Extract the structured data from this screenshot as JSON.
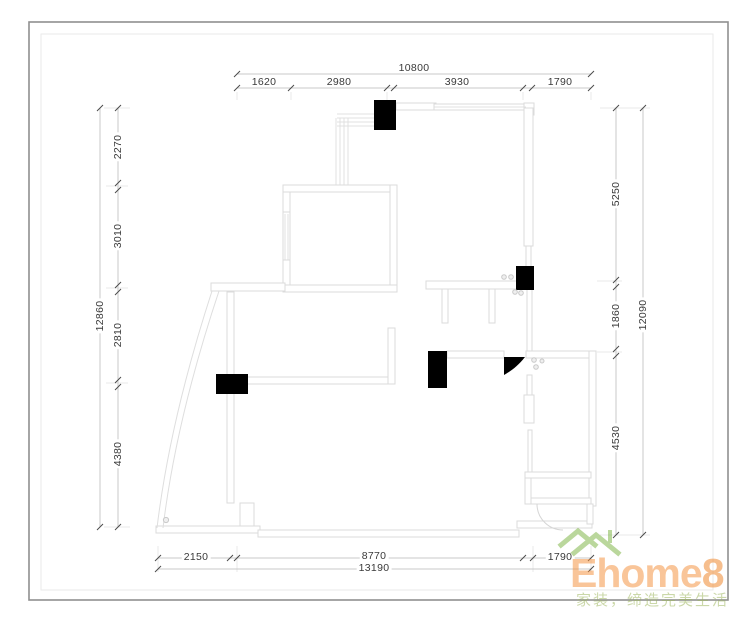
{
  "drawing": {
    "dimensions": {
      "top": {
        "total": "10800",
        "segments": [
          "1620",
          "2980",
          "3930",
          "1790"
        ]
      },
      "left": {
        "total": "12860",
        "segments": [
          "2270",
          "3010",
          "2810",
          "4380"
        ]
      },
      "right": {
        "total": "12090",
        "segments": [
          "5250",
          "1860",
          "4530"
        ]
      },
      "bottom": {
        "total": "13190",
        "segments": [
          "2150",
          "8770",
          "1790"
        ]
      }
    }
  },
  "watermark": {
    "brand": "Ehome",
    "brand_suffix": "8",
    "tagline": "家装，缔造完美生活"
  },
  "colors": {
    "wall_line": "#dbdbdb",
    "dim_line": "#c8c8c8",
    "dim_text": "#3a3a3a",
    "column_fill": "#000000",
    "brand_orange": "#f5923e",
    "roof_green": "#7cb342",
    "tagline_green": "#9db55c"
  }
}
